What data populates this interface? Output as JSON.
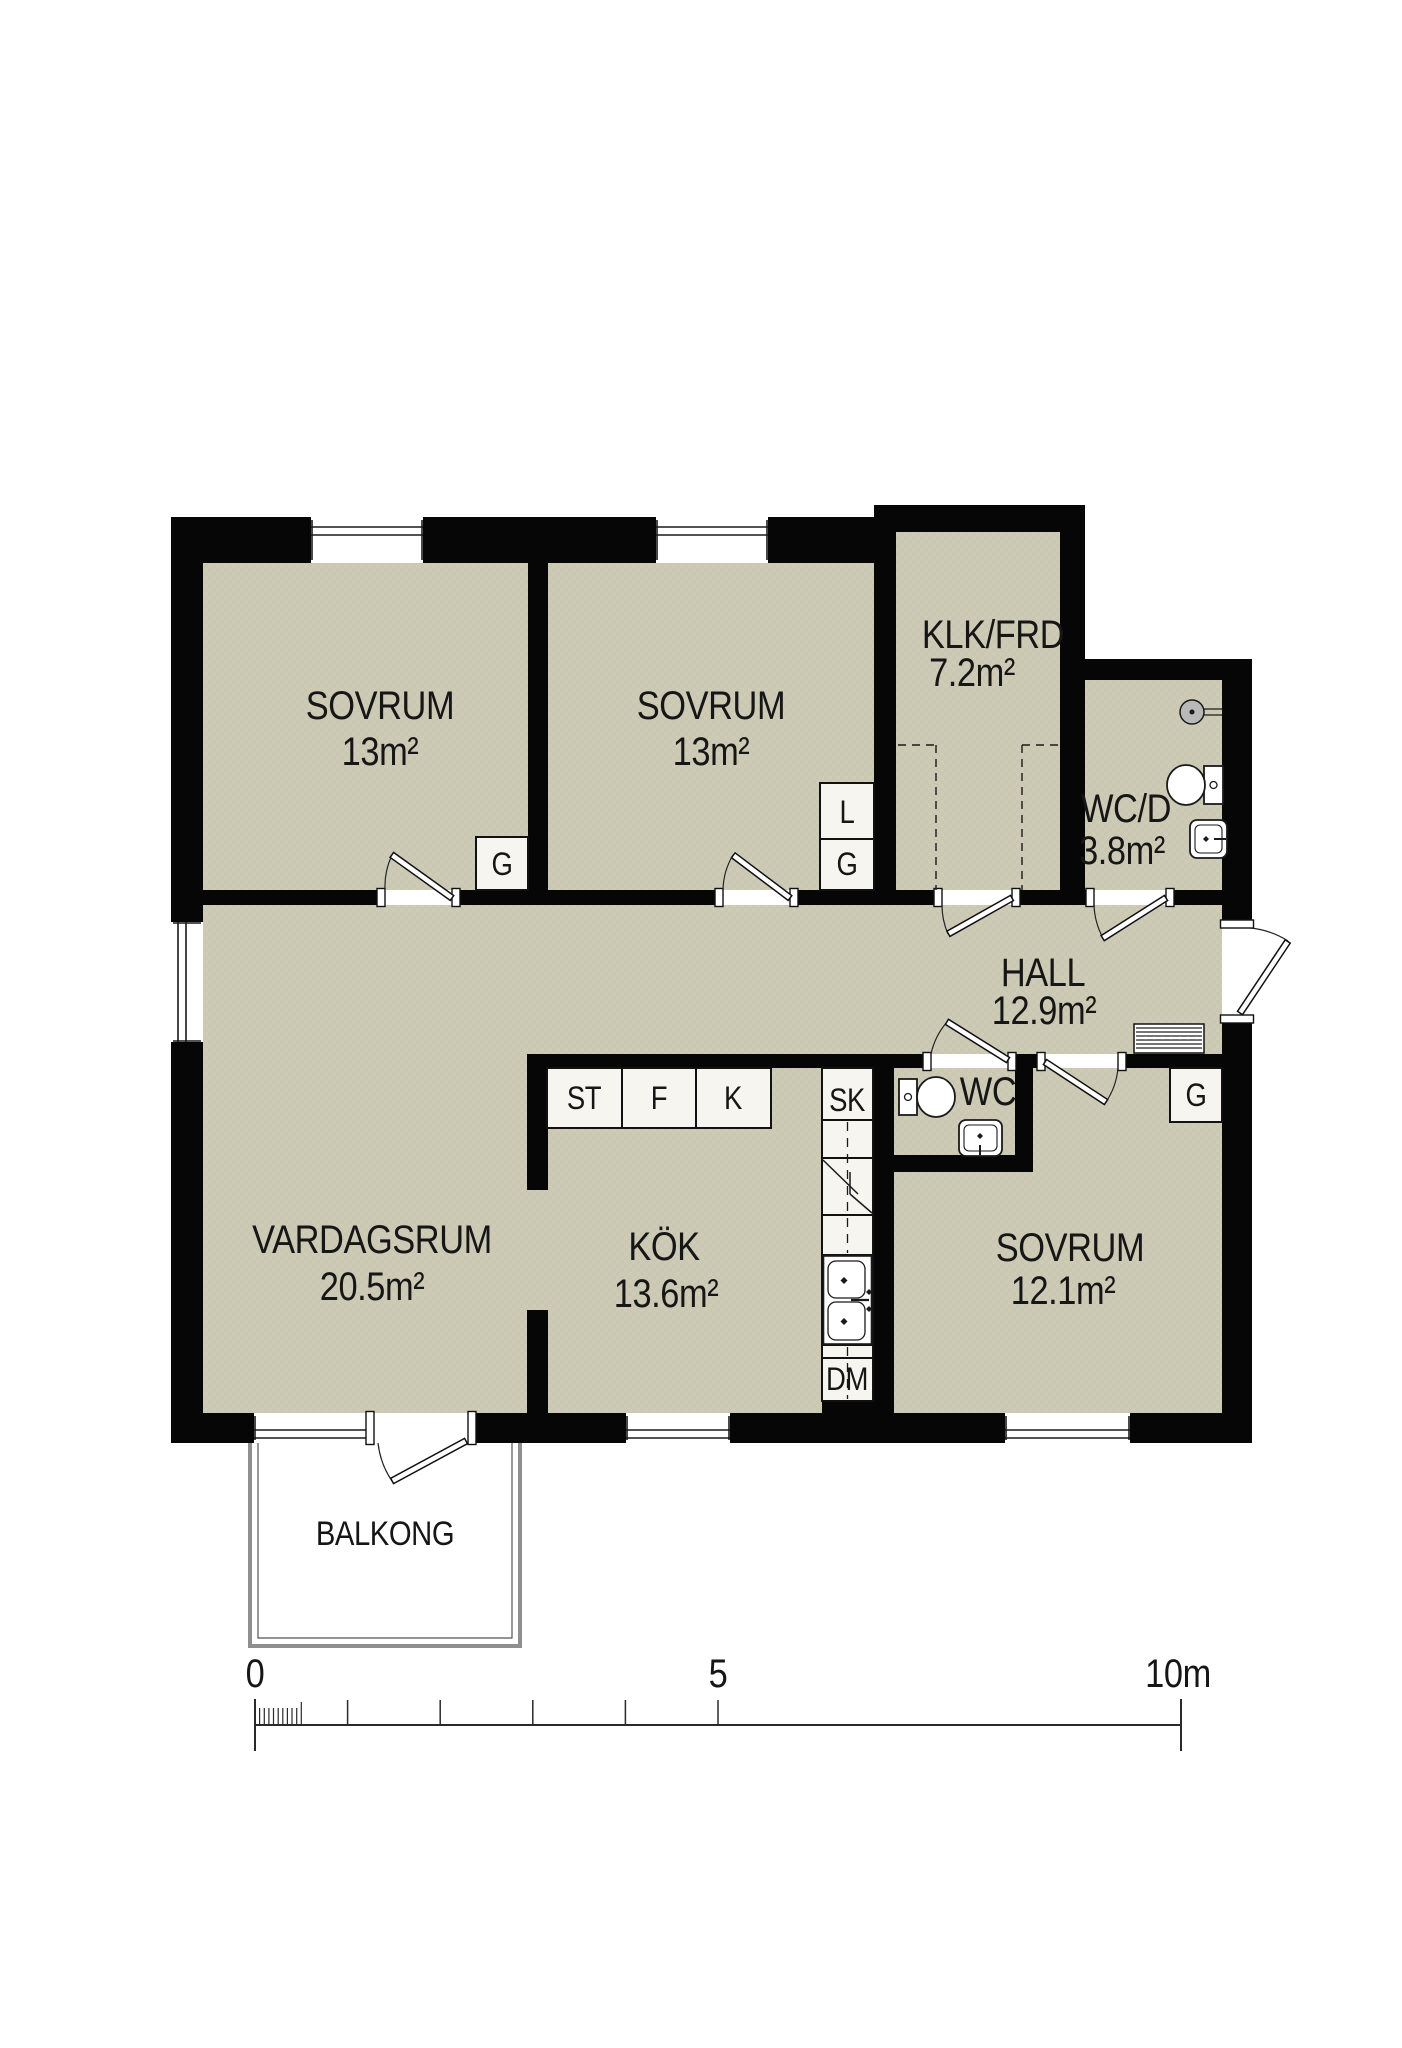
{
  "title": "apartment-floor-plan",
  "colors": {
    "paper": "#ffffff",
    "room_fill": "#cdcab5",
    "room_fill_alt": "#c8c5b0",
    "wall": "#060606",
    "cabinet_fill": "#f6f5f0",
    "railing_gray": "#8f8f8f",
    "fixture_gray": "#b9b9b9",
    "text": "#161616"
  },
  "rooms": {
    "sovrum_1": {
      "name": "SOVRUM",
      "area": "13m²"
    },
    "sovrum_2": {
      "name": "SOVRUM",
      "area": "13m²"
    },
    "klk_frd": {
      "name": "KLK/FRD",
      "area": "7.2m²"
    },
    "wc_d": {
      "name": "WC/D",
      "area": "3.8m²"
    },
    "hall": {
      "name": "HALL",
      "area": "12.9m²"
    },
    "vardagsrum": {
      "name": "VARDAGSRUM",
      "area": "20.5m²"
    },
    "kok": {
      "name": "KÖK",
      "area": "13.6m²"
    },
    "sovrum_3": {
      "name": "SOVRUM",
      "area": "12.1m²"
    },
    "wc": {
      "name": "WC"
    },
    "balkong": {
      "name": "BALKONG"
    }
  },
  "cabinets": {
    "wardrobe": "G",
    "linen": "L",
    "cleaning": "ST",
    "fridge": "F",
    "freezer": "K",
    "tall_cabinet": "SK",
    "dishwasher": "DM"
  },
  "scale_bar": {
    "zero": "0",
    "five": "5",
    "ten": "10m"
  }
}
